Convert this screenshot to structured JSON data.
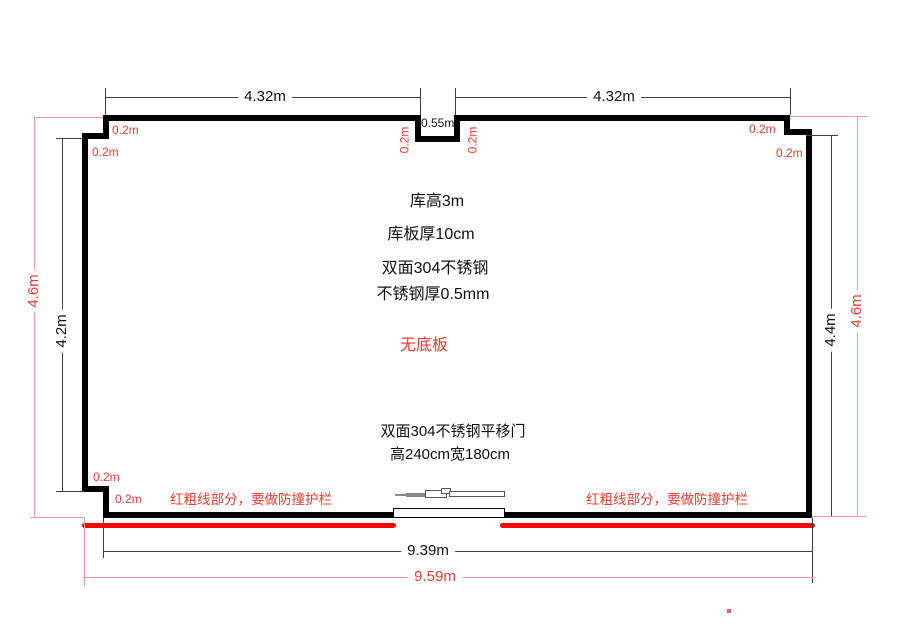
{
  "colors": {
    "wall": "#000000",
    "dim_line": "#404040",
    "red_text": "#ef3b2f",
    "red_heavy": "#fe0000",
    "red_dim": "#f29c9c"
  },
  "dims": {
    "top_left": "4.32m",
    "top_right": "4.32m",
    "notch_width": "0.55m",
    "left_outer": "4.6m",
    "left_inner": "4.2m",
    "right_inner": "4.4m",
    "right_outer": "4.6m",
    "bottom_inner": "9.39m",
    "bottom_outer": "9.59m",
    "offsets": [
      "0.2m",
      "0.2m",
      "0.2m",
      "0.2m",
      "0.2m",
      "0.2m",
      "0.2m",
      "0.2m"
    ]
  },
  "notes": {
    "center": [
      "库高3m",
      "库板厚10cm",
      "双面304不锈钢",
      "不锈钢厚0.5mm"
    ],
    "no_base": "无底板",
    "door_spec": "双面304不锈钢平移门",
    "door_size": "高240cm宽180cm",
    "guardrail_left": "红粗线部分，要做防撞护栏",
    "guardrail_right": "红粗线部分，要做防撞护栏"
  }
}
